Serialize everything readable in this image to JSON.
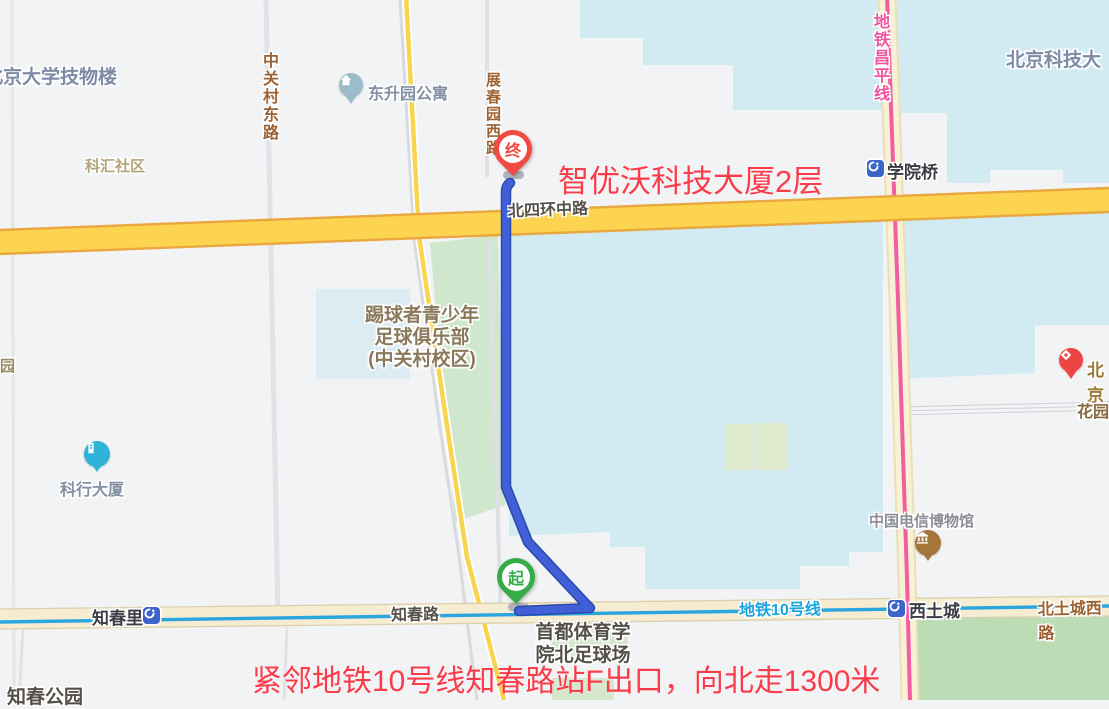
{
  "annotations": {
    "destination": "智优沃科技大厦2层",
    "route_tip": "紧邻地铁10号线知春路站F出口，向北走1300米"
  },
  "markers": {
    "start": "起",
    "end": "终"
  },
  "poi": {
    "pku_physics": "北京大学技物楼",
    "kehui_community": "科汇社区",
    "dongshengyuan_apartments": "东升园公寓",
    "ustb": "北京科技大",
    "soccer_club": "踢球者青少年\n足球俱乐部\n(中关村校区)",
    "yuan_partial": "园",
    "kehang_tower": "科行大厦",
    "beijing_partial": "北京",
    "huayuan": "花园",
    "telecom_museum": "中国电信博物馆",
    "capital_sport_field": "首都体育学\n院北足球场",
    "zhichun_park": "知春公园"
  },
  "roads": {
    "zhongguancun_east": "中关村东路",
    "zhanchunyuan_west": "展春园西路",
    "north_4th_ring": "北四环中路",
    "zhichun_road": "知春路",
    "beitucheng_west": "北土城西路"
  },
  "transit": {
    "changping_line": "地铁昌平线",
    "line_10": "地铁10号线",
    "stations": {
      "xueyuanqiao": "学院桥",
      "xitucheng": "西土城",
      "zhichunli": "知春里"
    }
  },
  "colors": {
    "route_blue": "#4160d8",
    "highway_yellow": "#fcd44f",
    "line10_cyan": "#2aa6de",
    "changping_pink": "#f15fa2",
    "campus_cyan": "#d2ebf2",
    "park_green": "#cfe7cd",
    "annotation_red": "#fa3c4a"
  }
}
